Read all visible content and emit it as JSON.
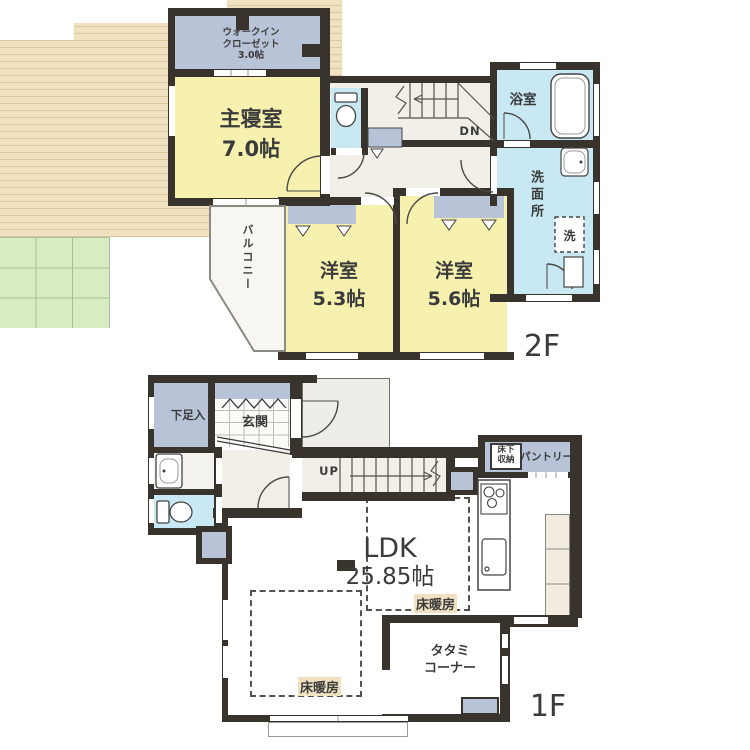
{
  "colors": {
    "wall": "#38332C",
    "room_yellow": "#F7F1AF",
    "closet_gray": "#B9C3D8",
    "water_blue": "#C8E8F4",
    "hall_cream": "#F2EFE9",
    "wood_floor": "#F0E2C1",
    "tatami_green": "#D9EBC3",
    "label_ink": "#3B3B3B"
  },
  "floor2": {
    "label": "2F",
    "wic1": "ウォークイン",
    "wic2": "クローゼット",
    "wic_size": "3.0帖",
    "master": "主寝室",
    "master_size": "7.0帖",
    "balcony": "バルコニー",
    "bath": "浴室",
    "washroom": "洗面所",
    "laundry": "洗",
    "down": "DN",
    "west1": "洋室",
    "west1_size": "5.3帖",
    "west2": "洋室",
    "west2_size": "5.6帖"
  },
  "floor1": {
    "label": "1F",
    "shoe": "下足入",
    "entrance": "玄関",
    "up": "UP",
    "underfloor1": "床下",
    "underfloor2": "収納",
    "pantry": "パントリー",
    "ldk": "LDK",
    "ldk_size": "25.85帖",
    "heat_left": "床暖房",
    "heat_right": "床暖房",
    "tatami1": "タタミ",
    "tatami2": "コーナー"
  }
}
